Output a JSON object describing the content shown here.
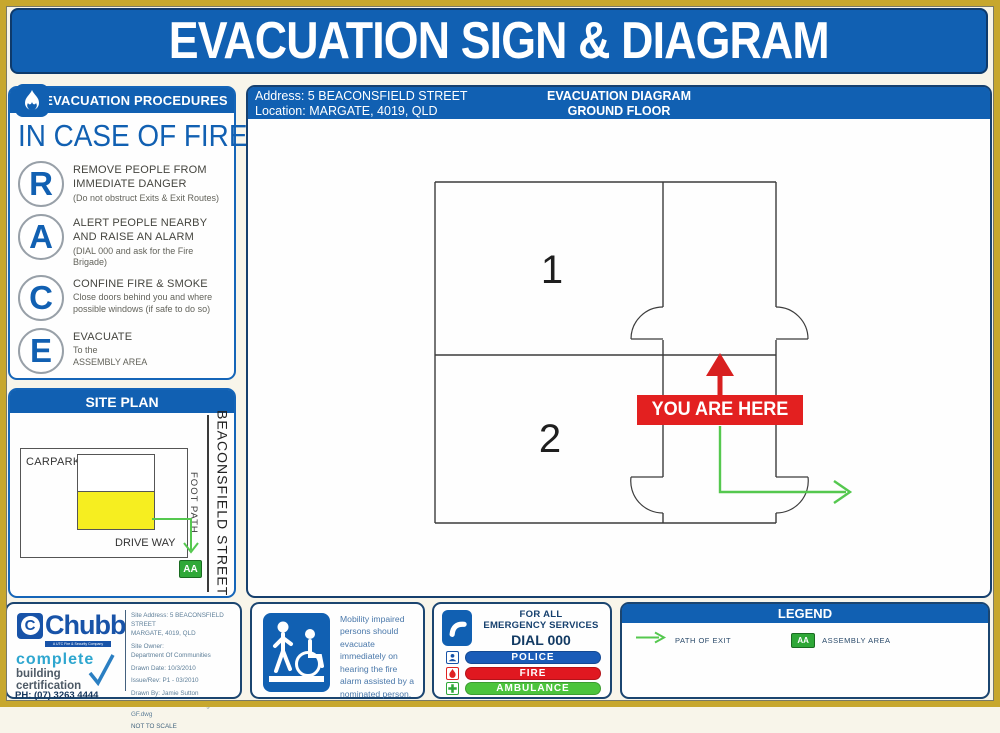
{
  "page": {
    "title": "EVACUATION SIGN & DIAGRAM"
  },
  "colors": {
    "primary_blue": "#1160b2",
    "navy_border": "#16406e",
    "red": "#e32020",
    "path_green": "#55c84f",
    "assembly_green": "#2fa838",
    "building_yellow": "#f6ee20",
    "gold_frame": "#c7a72e"
  },
  "procedures": {
    "header": "EVACUATION PROCEDURES",
    "subtitle": "IN CASE OF FIRE",
    "steps": [
      {
        "letter": "R",
        "title": "REMOVE PEOPLE FROM\nIMMEDIATE DANGER",
        "note": "(Do not obstruct Exits & Exit Routes)"
      },
      {
        "letter": "A",
        "title": "ALERT PEOPLE NEARBY\nAND RAISE AN ALARM",
        "note": "(DIAL 000 and ask for the Fire Brigade)"
      },
      {
        "letter": "C",
        "title": "CONFINE FIRE & SMOKE",
        "note": "Close doors behind you and where\npossible windows (if safe to do so)"
      },
      {
        "letter": "E",
        "title": "EVACUATE",
        "note": "To the\nASSEMBLY AREA"
      }
    ]
  },
  "site_plan": {
    "header": "SITE PLAN",
    "carpark": "CARPARK",
    "driveway": "DRIVE WAY",
    "footpath": "FOOT PATH",
    "street": "BEACONSFIELD STREET",
    "assembly_badge": "AA"
  },
  "diagram": {
    "address_line1": "Address: 5 BEACONSFIELD STREET",
    "address_line2": "Location: MARGATE, 4019, QLD",
    "title_line1": "EVACUATION DIAGRAM",
    "title_line2": "GROUND FLOOR",
    "room1": "1",
    "room2": "2",
    "you_are_here": "YOU ARE HERE"
  },
  "chubb": {
    "brand_initial": "C",
    "brand": "Chubb",
    "brand_sub": "A UTC Fire & Security Company",
    "tagline1": "complete",
    "tagline2": "building\ncertification",
    "phone": "PH: (07) 3263 4444",
    "details": [
      "Site Address: 5 BEACONSFIELD STREET",
      "MARGATE, 4019, QLD",
      "Site Owner:",
      "Department Of Communities",
      "Drawn Date: 10/3/2010",
      "Issue/Rev: P1 - 03/2010",
      "Drawn By: Jamie Sutton",
      "File: 5 Beaconsfield St Margate GF.dwg",
      "NOT TO SCALE"
    ]
  },
  "mobility": {
    "text": "Mobility impaired persons should evacuate immediately on hearing the fire alarm assisted by a nominated person."
  },
  "emergency": {
    "line1": "FOR ALL",
    "line2": "EMERGENCY SERVICES",
    "dial": "DIAL 000",
    "services": [
      {
        "label": "POLICE",
        "color": "#1a5cb8"
      },
      {
        "label": "FIRE",
        "color": "#e01820"
      },
      {
        "label": "AMBULANCE",
        "color": "#4cc43c"
      }
    ]
  },
  "legend": {
    "header": "LEGEND",
    "path_of_exit": "PATH OF EXIT",
    "assembly_badge": "AA",
    "assembly_area": "ASSEMBLY AREA"
  },
  "icons": {
    "flame": "flame-icon",
    "wheelchair": "wheelchair-icon",
    "phone": "phone-icon",
    "police": "police-icon",
    "fire": "fire-icon",
    "ambulance": "ambulance-icon",
    "checkmark": "checkmark-icon",
    "exit_arrow": "exit-arrow-icon"
  }
}
